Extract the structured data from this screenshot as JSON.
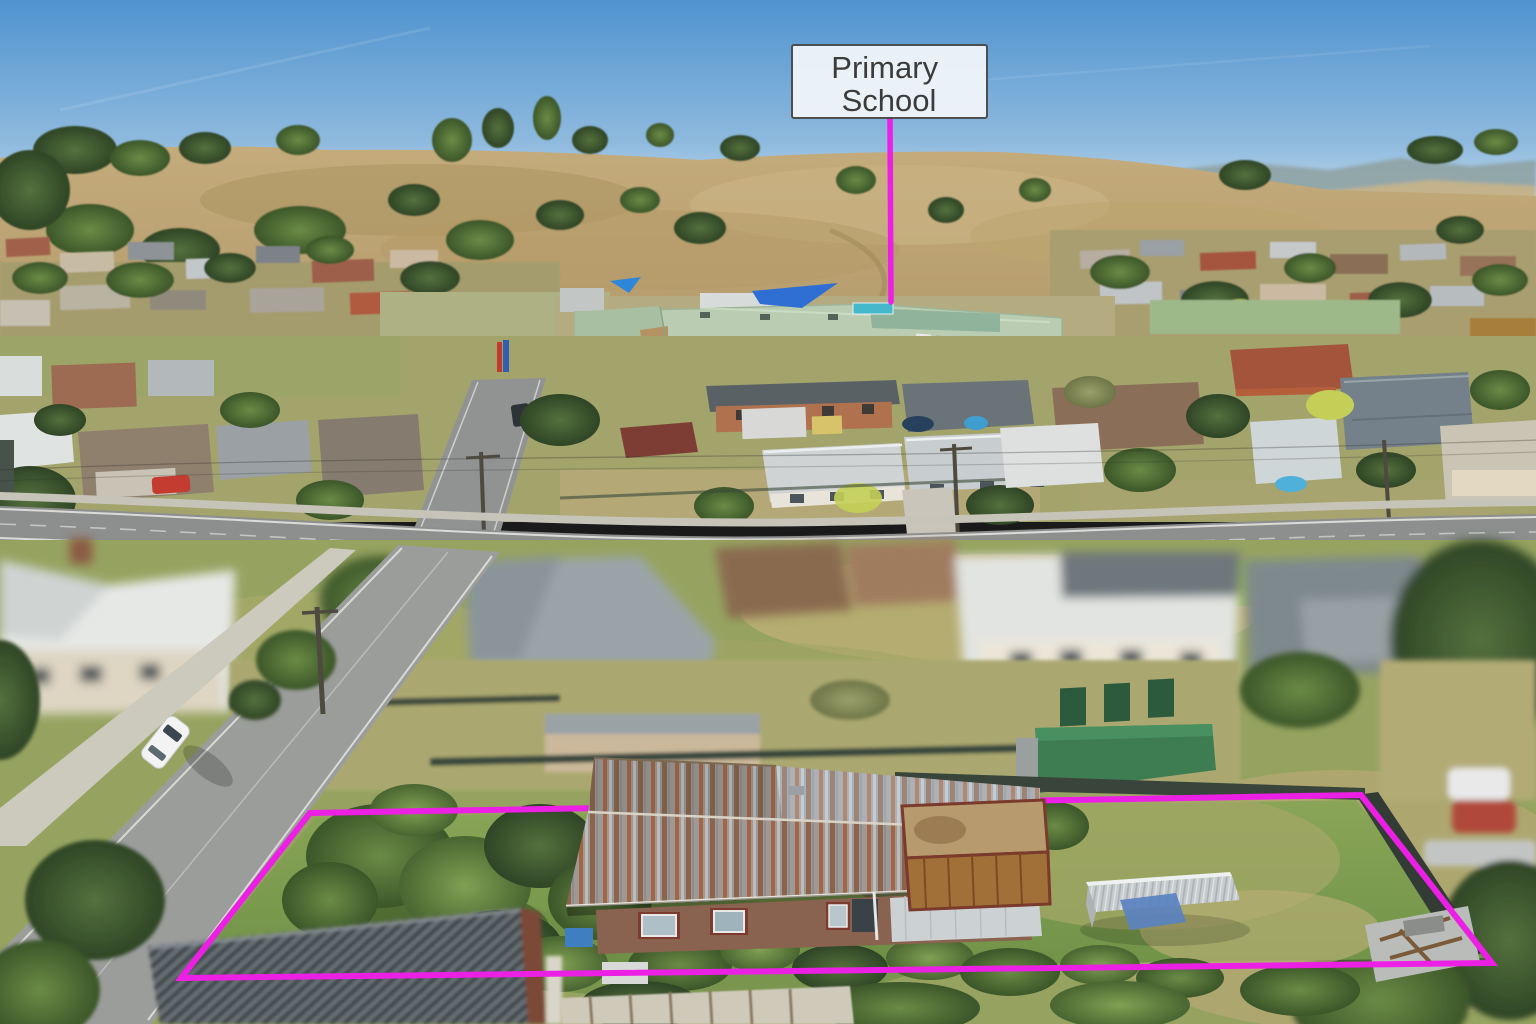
{
  "annotations": {
    "school_label": {
      "line1": "Primary",
      "line2": "School",
      "text_color": "#3c3c3c",
      "box_bg": "#f1f5f9",
      "box_border": "#4a4a4a"
    },
    "marker_color": "#ec1fe4"
  }
}
